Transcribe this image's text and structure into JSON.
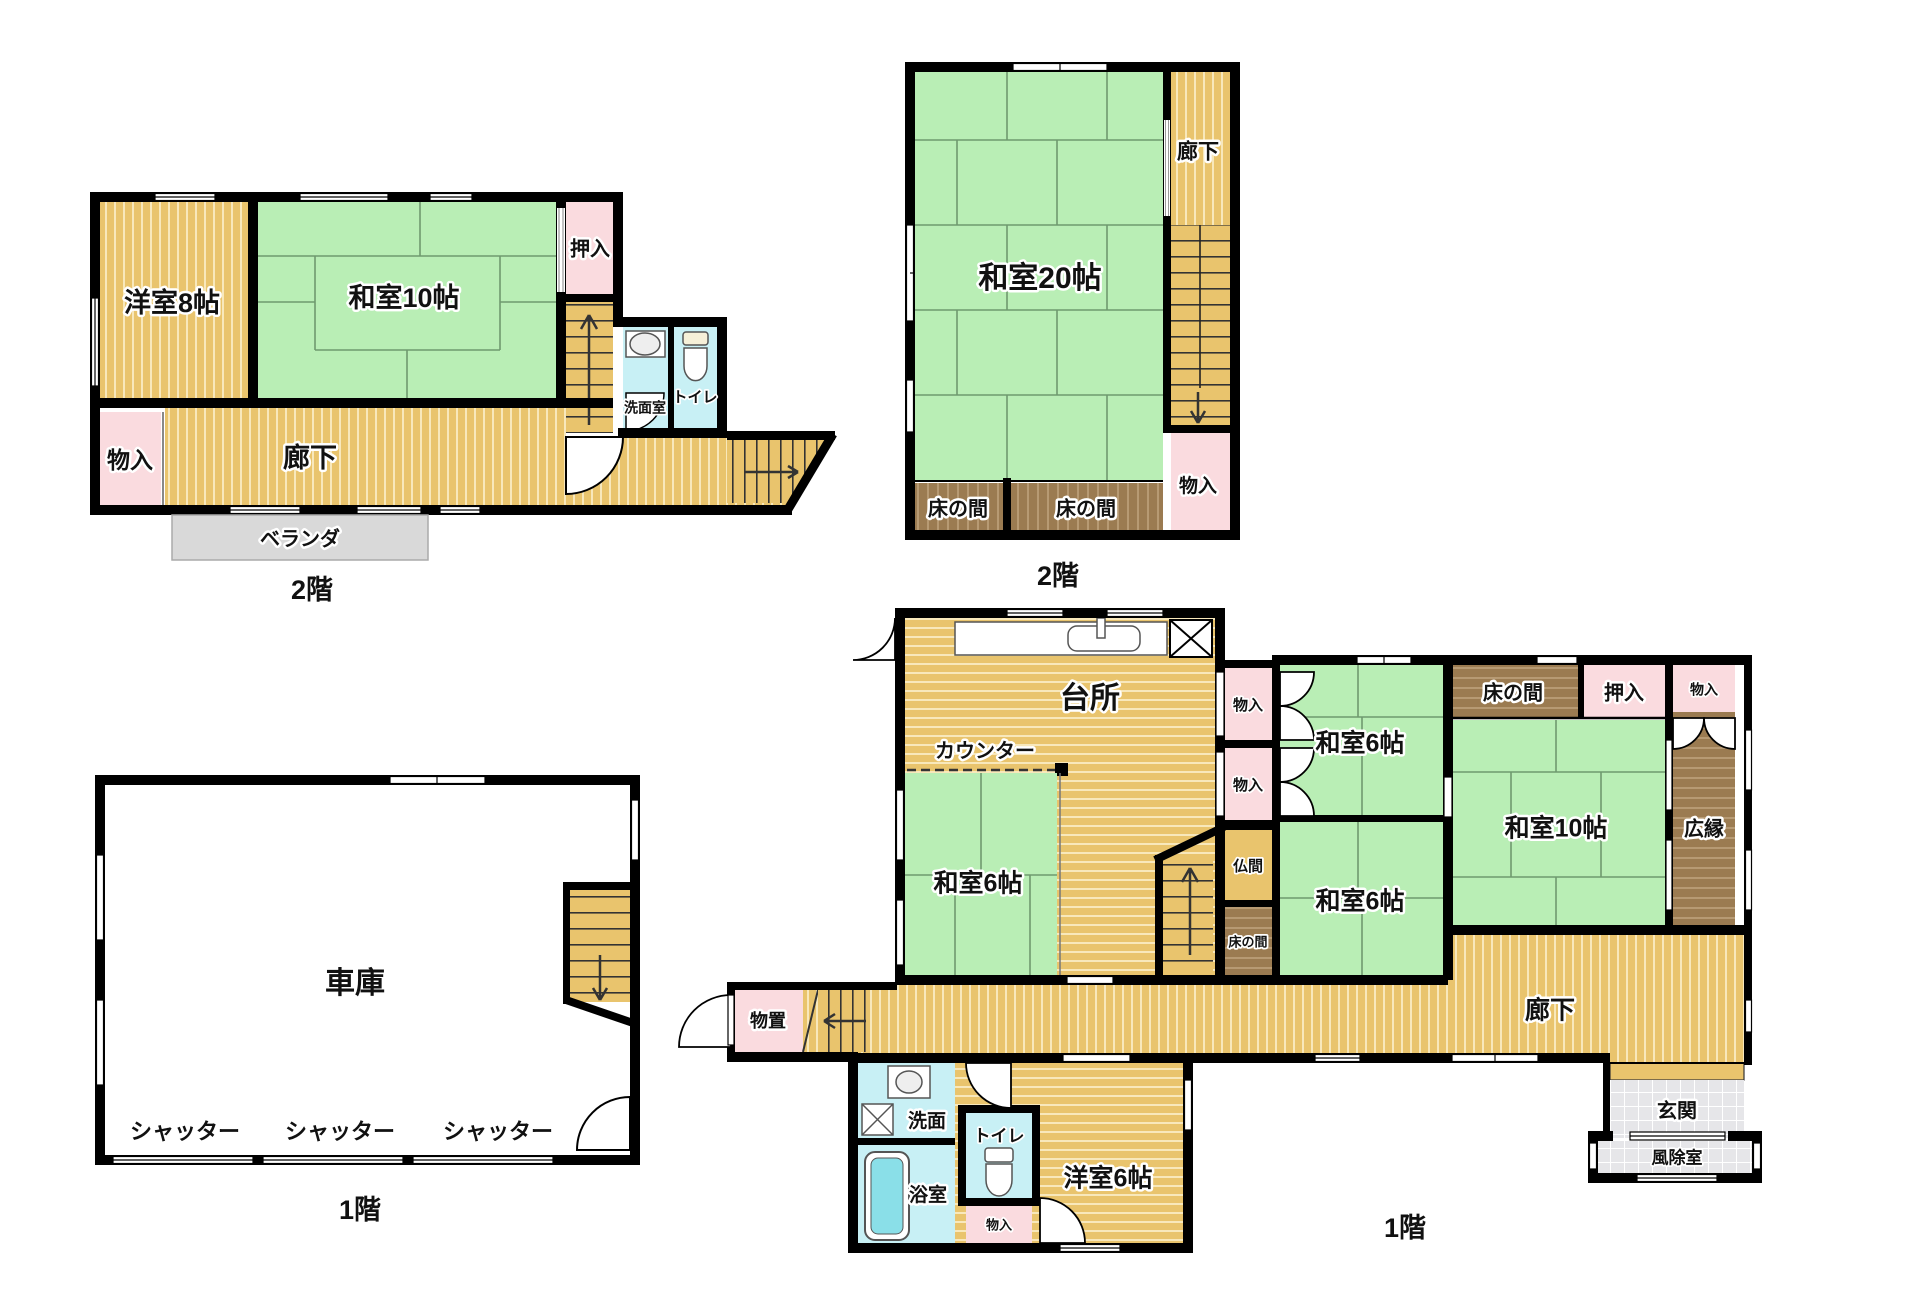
{
  "colors": {
    "wall": "#000000",
    "wood": "#e9c46d",
    "wood_stripe": "#f8e8bb",
    "tatami": "#b9eeb5",
    "tatami_line": "#6f9a6f",
    "closet_pink": "#fadbdf",
    "wet_cyan": "#c8f0f5",
    "tub_cyan": "#8adfe8",
    "brown": "#9b7b51",
    "veranda_gray": "#d9d9d9",
    "entrance_gray": "#e6e6e9"
  },
  "plans": {
    "upper_left": {
      "floor_label": "2階",
      "rooms": {
        "western8": "洋室8帖",
        "japanese10": "和室10帖",
        "oshiire": "押入",
        "monoiri": "物入",
        "corridor": "廊下",
        "washroom": "洗面室",
        "toilet": "トイレ",
        "veranda": "ベランダ"
      }
    },
    "upper_right": {
      "floor_label": "2階",
      "rooms": {
        "japanese20": "和室20帖",
        "corridor": "廊下",
        "tokonoma_left": "床の間",
        "tokonoma_right": "床の間",
        "monoiri": "物入"
      }
    },
    "lower_left": {
      "floor_label": "1階",
      "rooms": {
        "garage": "車庫",
        "shutter1": "シャッター",
        "shutter2": "シャッター",
        "shutter3": "シャッター"
      }
    },
    "lower_right": {
      "floor_label": "1階",
      "rooms": {
        "kitchen": "台所",
        "counter": "カウンター",
        "japanese6_kitchen": "和室6帖",
        "monoiri_a": "物入",
        "monoiri_b": "物入",
        "butsuma": "仏間",
        "tokonoma_small": "床の間",
        "japanese6_top": "和室6帖",
        "tokonoma_top": "床の間",
        "oshiire": "押入",
        "monoiri_top": "物入",
        "japanese10": "和室10帖",
        "hiroen": "広縁",
        "japanese6_bottom": "和室6帖",
        "corridor": "廊下",
        "storage": "物置",
        "washbasin": "洗面",
        "bathroom": "浴室",
        "toilet": "トイレ",
        "monoiri_toilet": "物入",
        "western6": "洋室6帖",
        "genkan": "玄関",
        "windbreak": "風除室"
      }
    }
  }
}
